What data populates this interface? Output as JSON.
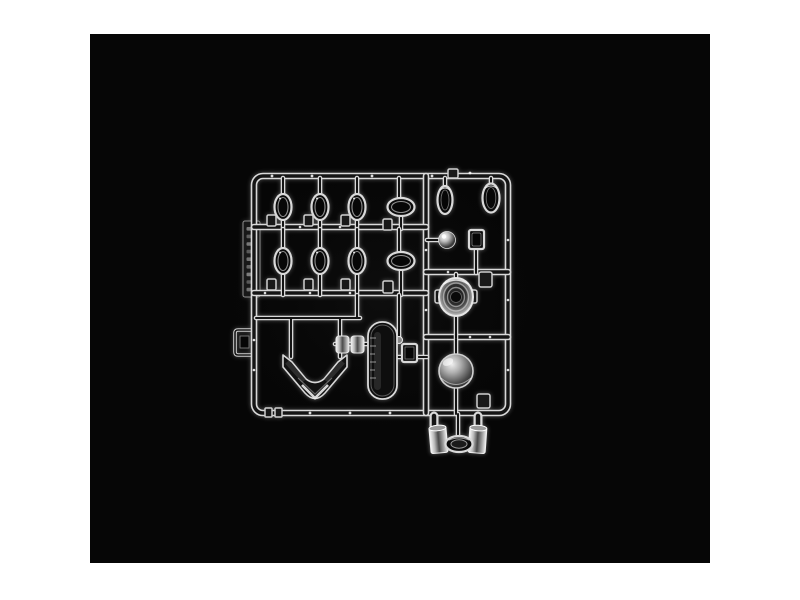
{
  "scene": {
    "type": "product-photograph",
    "subject": "clear transparent plastic model kit sprue (injection-molded parts tree)",
    "aria_label": "Photograph of a clear plastic model kit sprue with transparent parts on a black studio background",
    "background": "black studio backdrop inset on a white page",
    "object_material": "clear transparent polystyrene",
    "parts_inventory": [
      {
        "name": "vertical oval lens rings",
        "count": 6
      },
      {
        "name": "wide horizontal oval lenses",
        "count": 2
      },
      {
        "name": "teardrop lenses (top right)",
        "count": 2
      },
      {
        "name": "ball lens",
        "count": 1
      },
      {
        "name": "small rectangular block",
        "count": 1
      },
      {
        "name": "ribbed round headlight lens",
        "count": 1
      },
      {
        "name": "smooth dome lens",
        "count": 1
      },
      {
        "name": "wrap-around windshield",
        "count": 1
      },
      {
        "name": "rounded window panel",
        "count": 1
      },
      {
        "name": "barrel clamp connectors",
        "count": 2
      },
      {
        "name": "cylindrical light buckets (below frame)",
        "count": 2
      },
      {
        "name": "bottom oval lens (below frame)",
        "count": 1
      },
      {
        "name": "square gate tabs",
        "count": 8
      },
      {
        "name": "molded identification tag",
        "count": 1
      },
      {
        "name": "side bracket clip",
        "count": 1
      }
    ]
  },
  "colors": {
    "page-bg": "#ffffff",
    "photo-bg": "#060606",
    "plastic-bright": "#d9d9d9",
    "plastic-core": "#141414"
  }
}
